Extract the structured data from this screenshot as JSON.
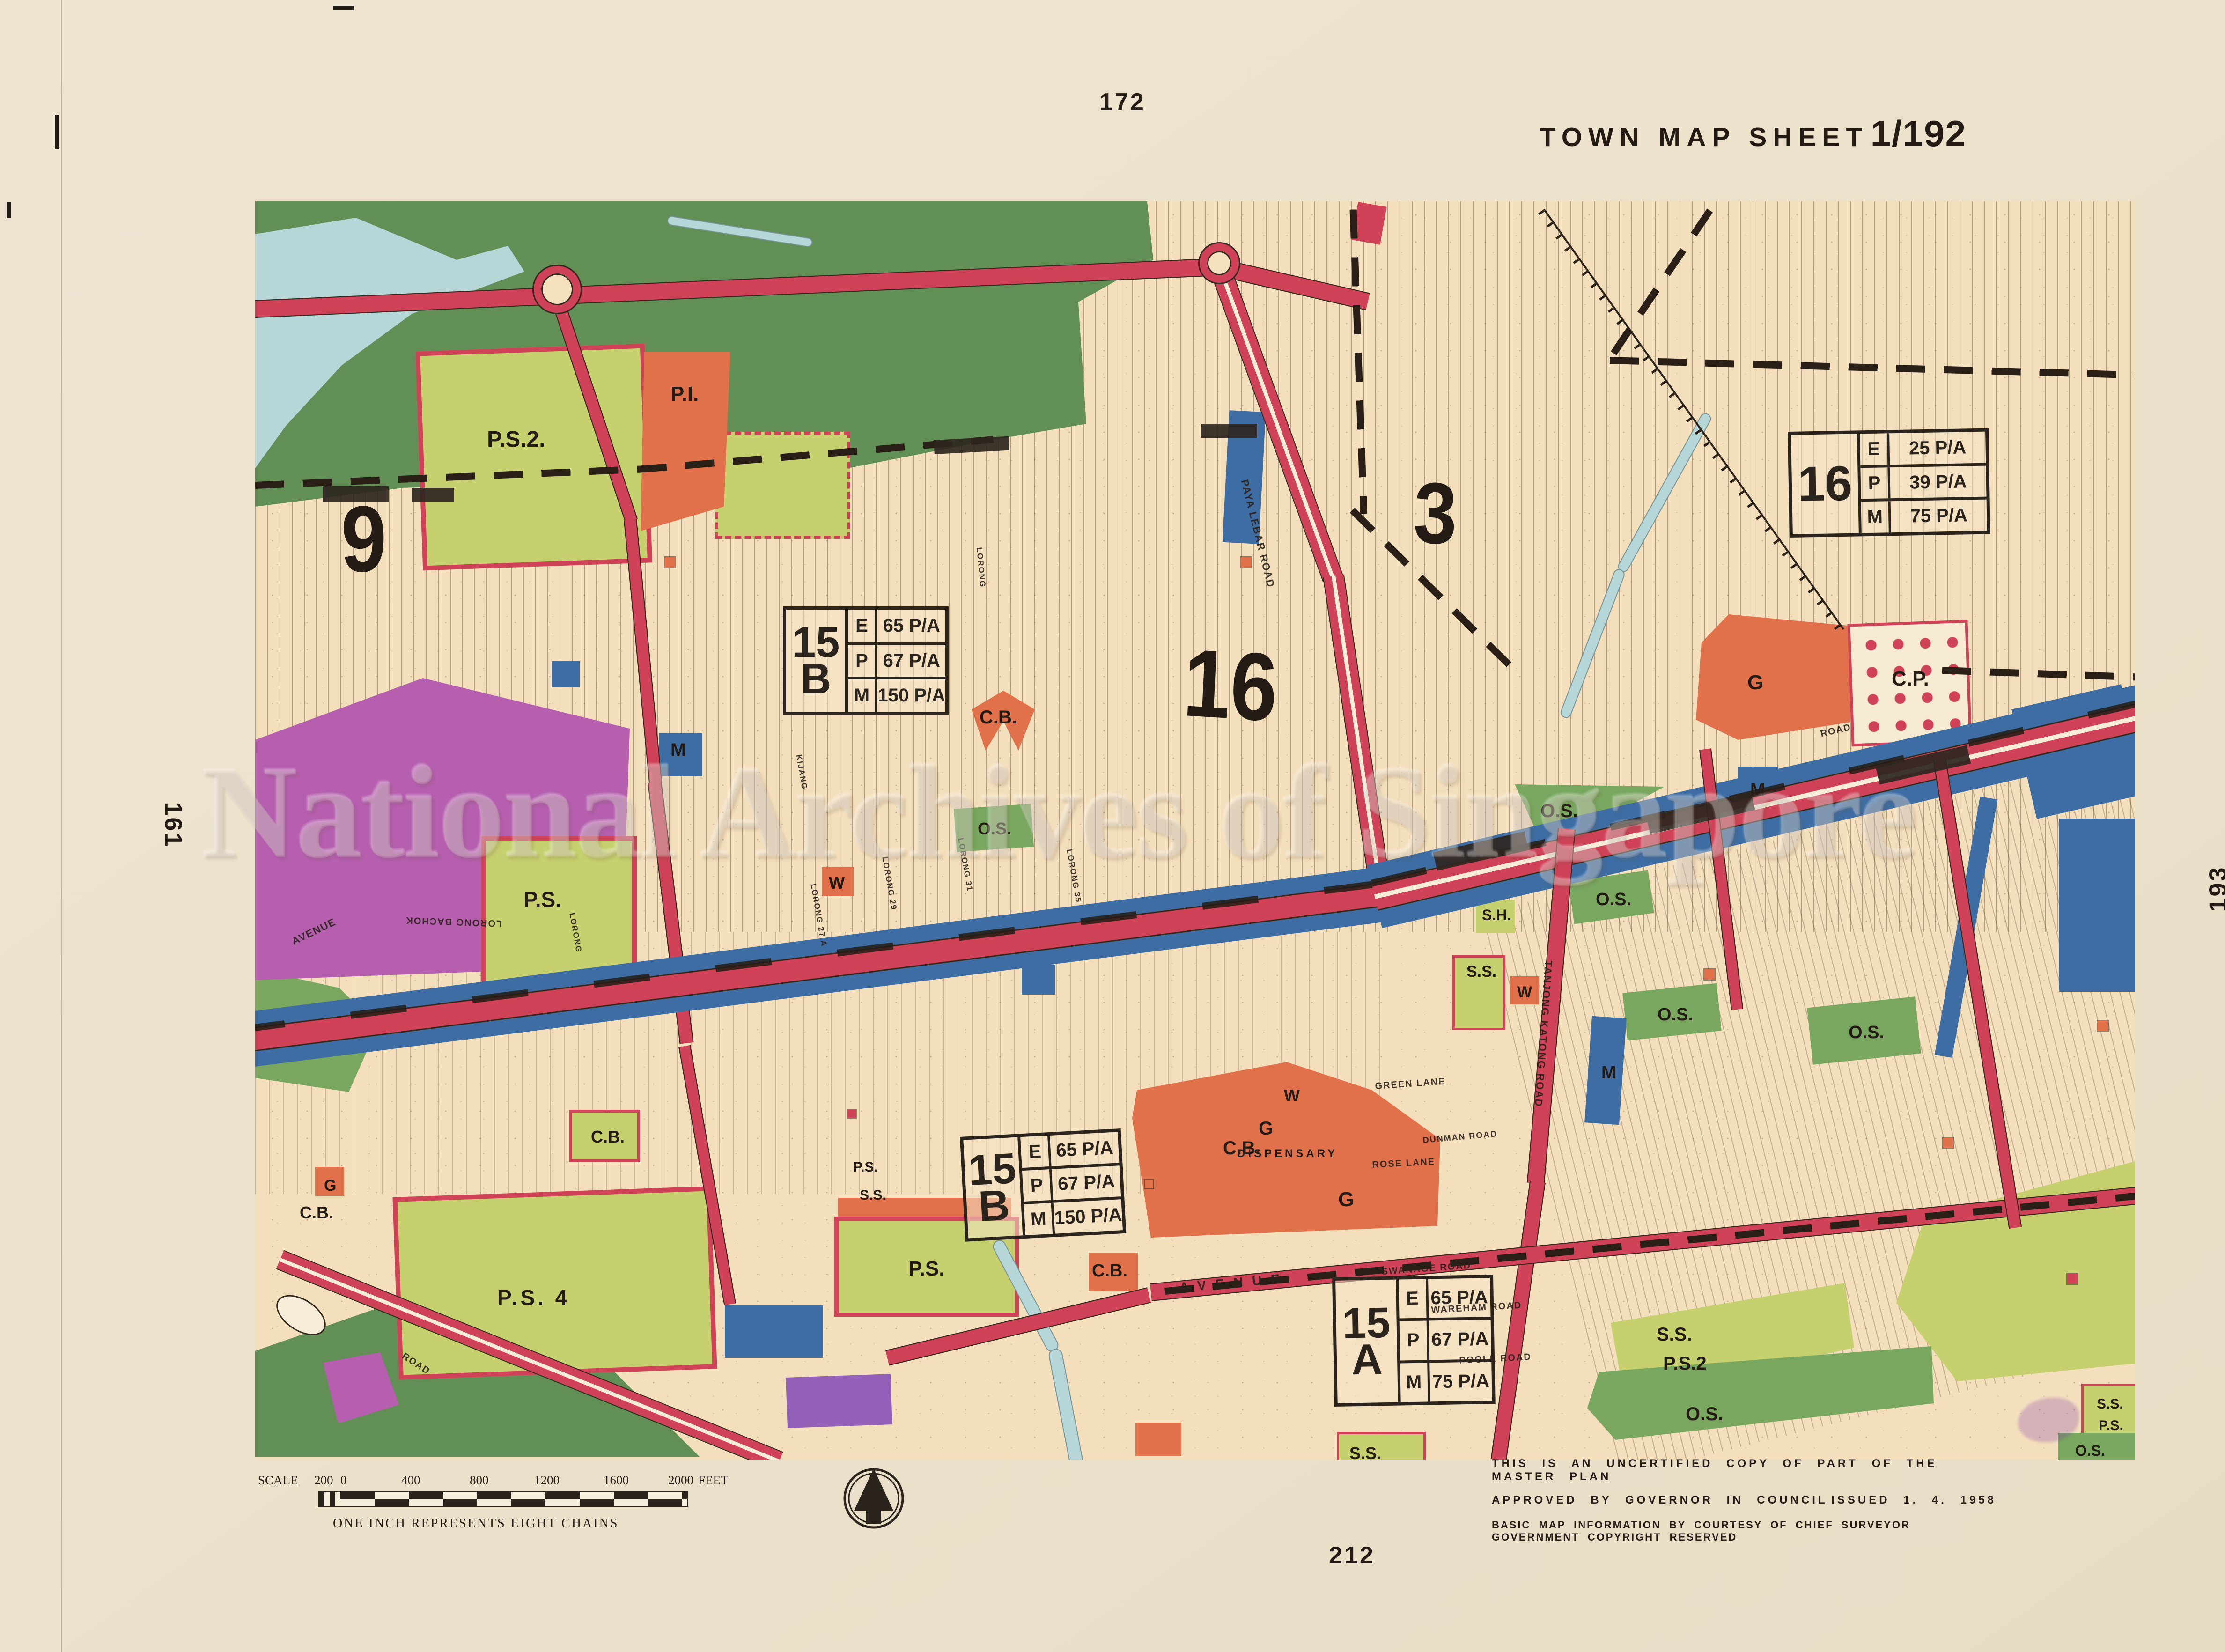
{
  "sheet": {
    "title_prefix": "TOWN MAP SHEET",
    "title_number": "1/192",
    "adjacent_top": "172",
    "adjacent_left": "161",
    "adjacent_right": "193",
    "adjacent_bottom": "212"
  },
  "scale_bar": {
    "label": "SCALE",
    "ticks": [
      "200",
      "0",
      "400",
      "800",
      "1200",
      "1600",
      "2000"
    ],
    "unit": "FEET",
    "caption": "ONE INCH REPRESENTS EIGHT CHAINS"
  },
  "notes": {
    "line1": "THIS IS AN UNCERTIFIED COPY OF PART OF THE MASTER PLAN",
    "line2_left": "APPROVED BY GOVERNOR IN COUNCIL",
    "line2_right": "ISSUED 1. 4. 1958",
    "line3": "BASIC MAP INFORMATION BY COURTESY OF CHIEF SURVEYOR GOVERNMENT COPYRIGHT RESERVED"
  },
  "watermark": "National Archives of Singapore",
  "zone_numbers": [
    {
      "t": "9"
    },
    {
      "t": "16"
    },
    {
      "t": "3"
    }
  ],
  "density_boxes": [
    {
      "num": "15",
      "letter": "B",
      "rows": [
        {
          "u": "E",
          "v": "65 P/A"
        },
        {
          "u": "P",
          "v": "67 P/A"
        },
        {
          "u": "M",
          "v": "150 P/A"
        }
      ]
    },
    {
      "num": "15",
      "letter": "B",
      "rows": [
        {
          "u": "E",
          "v": "65 P/A"
        },
        {
          "u": "P",
          "v": "67 P/A"
        },
        {
          "u": "M",
          "v": "150 P/A"
        }
      ]
    },
    {
      "num": "15",
      "letter": "A",
      "rows": [
        {
          "u": "E",
          "v": "65 P/A"
        },
        {
          "u": "P",
          "v": "67 P/A"
        },
        {
          "u": "M",
          "v": "75 P/A"
        }
      ]
    },
    {
      "num": "16",
      "letter": "",
      "rows": [
        {
          "u": "E",
          "v": "25 P/A"
        },
        {
          "u": "P",
          "v": "39 P/A"
        },
        {
          "u": "M",
          "v": "75 P/A"
        }
      ]
    }
  ],
  "labels": [
    {
      "t": "P.S.2."
    },
    {
      "t": "P.I."
    },
    {
      "t": "P.S."
    },
    {
      "t": "O.S."
    },
    {
      "t": "C.B."
    },
    {
      "t": "M"
    },
    {
      "t": "W"
    },
    {
      "t": "O.S."
    },
    {
      "t": "O.S."
    },
    {
      "t": "O.S."
    },
    {
      "t": "O.S."
    },
    {
      "t": "S.H."
    },
    {
      "t": "S.S."
    },
    {
      "t": "M"
    },
    {
      "t": "M"
    },
    {
      "t": "G"
    },
    {
      "t": "C.P."
    },
    {
      "t": "W"
    },
    {
      "t": "C.B."
    },
    {
      "t": "G"
    },
    {
      "t": "W"
    },
    {
      "t": "DISPENSARY"
    },
    {
      "t": "G"
    },
    {
      "t": "C.B."
    },
    {
      "t": "P.S."
    },
    {
      "t": "S.S."
    },
    {
      "t": "P.S."
    },
    {
      "t": "C.B."
    },
    {
      "t": "C.B."
    },
    {
      "t": "G"
    },
    {
      "t": "P.S. 4"
    },
    {
      "t": "S.S."
    },
    {
      "t": "P.S.2"
    },
    {
      "t": "O.S."
    },
    {
      "t": "S.S."
    },
    {
      "t": "S.S."
    },
    {
      "t": "P.S."
    },
    {
      "t": "O.S."
    }
  ],
  "streets": [
    {
      "t": "PAYA LEBAR ROAD"
    },
    {
      "t": "TANJONG KATONG ROAD"
    },
    {
      "t": "SWANAGE ROAD"
    },
    {
      "t": "WAREHAM ROAD"
    },
    {
      "t": "POOLE ROAD"
    },
    {
      "t": "GREEN LANE"
    },
    {
      "t": "ROSE LANE"
    },
    {
      "t": "AVENUE"
    },
    {
      "t": "AVENUE"
    },
    {
      "t": "LORONG BACHOK"
    },
    {
      "t": "LORONG 27 A"
    },
    {
      "t": "LORONG 29"
    },
    {
      "t": "LORONG 31"
    },
    {
      "t": "LORONG 35"
    },
    {
      "t": "KIJANG"
    },
    {
      "t": "ROAD"
    },
    {
      "t": "ROAD"
    },
    {
      "t": "DUNMAN ROAD"
    },
    {
      "t": "LORONG"
    },
    {
      "t": "LORONG"
    }
  ],
  "legend_colors": {
    "main_road": "#cf4257",
    "commercial_blue": "#3d6da3",
    "open_space_green": "#79a75f",
    "school_lime": "#c6d06e",
    "civic_orange": "#e0714a",
    "residential_magenta": "#b55fae",
    "water": "#b7d6d8",
    "rural_green": "#618f55",
    "paper": "#ece3d0",
    "map_cream": "#f4dfbd"
  }
}
